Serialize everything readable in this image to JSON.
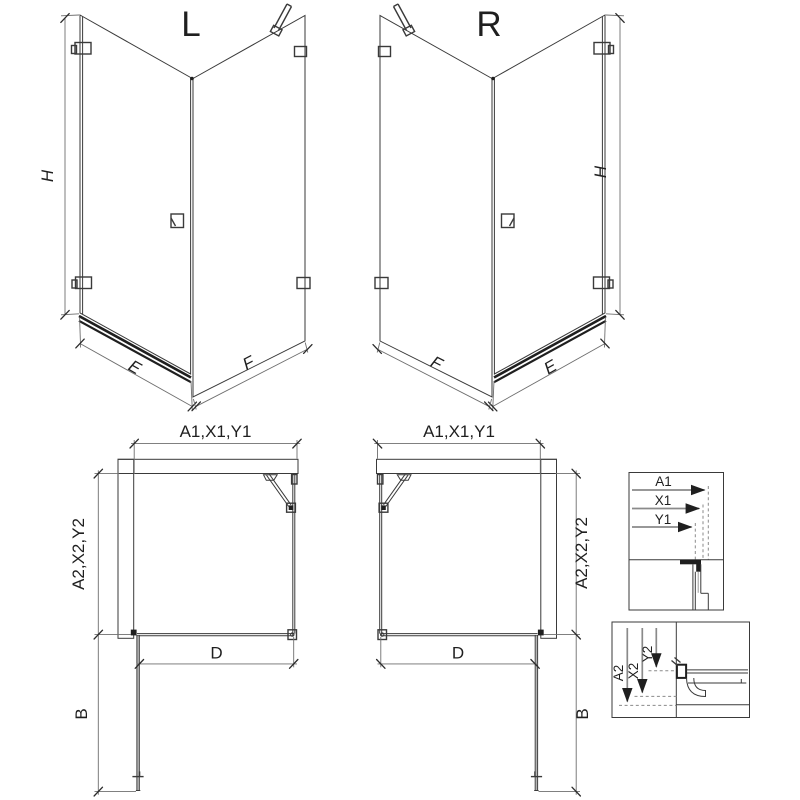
{
  "views": {
    "iso_left": {
      "name": "L",
      "h": "H",
      "e": "E",
      "f": "F"
    },
    "iso_right": {
      "name": "R",
      "h": "H",
      "e": "E",
      "f": "F"
    },
    "plan_left": {
      "a1": "A1,X1,Y1",
      "a2": "A2,X2,Y2",
      "d": "D",
      "b": "B"
    },
    "plan_right": {
      "a1": "A1,X1,Y1",
      "a2": "A2,X2,Y2",
      "d": "D",
      "b": "B"
    },
    "detail_top": {
      "a1": "A1",
      "x1": "X1",
      "y1": "Y1"
    },
    "detail_bottom": {
      "a2": "A2",
      "x2": "X2",
      "y2": "Y2"
    }
  },
  "colors": {
    "line": "#3a3a3a",
    "dimension": "#6e6e6e",
    "dark": "#1f1f1f",
    "hatch": "#5a5a5a",
    "background": "#ffffff"
  }
}
